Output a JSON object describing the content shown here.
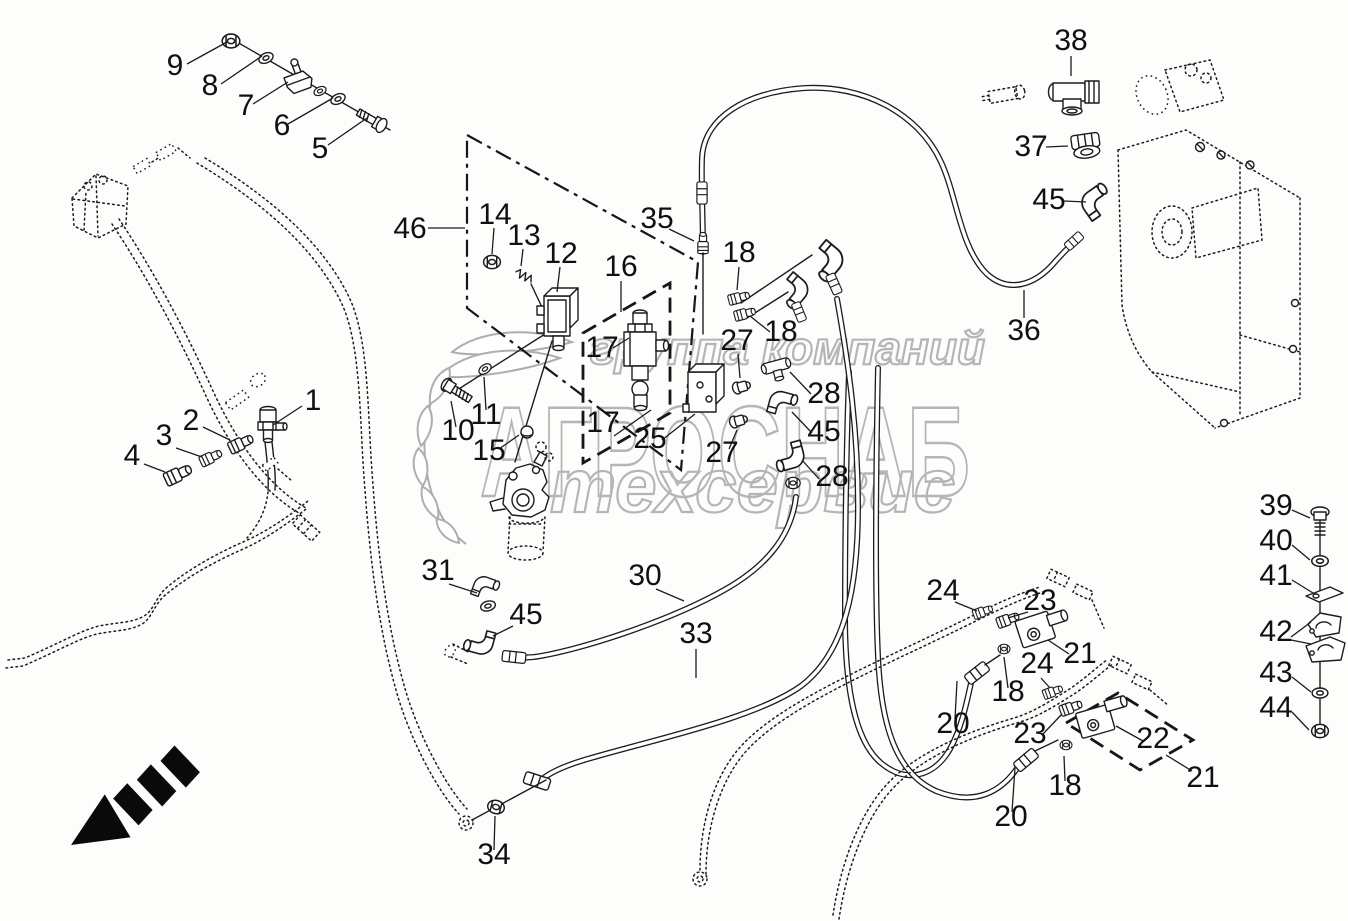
{
  "figure": {
    "type": "exploded-parts-diagram",
    "background": "#fdfdfb",
    "line_color": "#1c1c1c",
    "watermark": {
      "line1": "группа компаний",
      "line2": "АГРОСНАБ",
      "line3": "техсервис",
      "color": "#b5b5b5",
      "emblem": "laurel-wreath"
    },
    "direction_arrow": {
      "meaning": "viewing-direction-arrow",
      "points": "down-left"
    },
    "callouts": [
      {
        "label": "9",
        "x": 175,
        "y": 75,
        "leader": [
          187,
          64,
          227,
          42
        ]
      },
      {
        "label": "8",
        "x": 210,
        "y": 95,
        "leader": [
          221,
          84,
          262,
          56
        ]
      },
      {
        "label": "7",
        "x": 246,
        "y": 115,
        "leader": [
          253,
          104,
          288,
          82
        ]
      },
      {
        "label": "6",
        "x": 282,
        "y": 135,
        "leader": [
          288,
          124,
          333,
          98
        ]
      },
      {
        "label": "5",
        "x": 320,
        "y": 158,
        "leader": [
          328,
          145,
          367,
          118
        ]
      },
      {
        "label": "46",
        "x": 410,
        "y": 238,
        "leader": [
          428,
          228,
          465,
          228
        ]
      },
      {
        "label": "14",
        "x": 495,
        "y": 224,
        "leader": [
          494,
          228,
          492,
          254
        ]
      },
      {
        "label": "13",
        "x": 524,
        "y": 245,
        "leader": [
          523,
          249,
          521,
          266
        ]
      },
      {
        "label": "12",
        "x": 561,
        "y": 263,
        "leader": [
          560,
          267,
          557,
          292
        ]
      },
      {
        "label": "16",
        "x": 621,
        "y": 276,
        "leader": [
          621,
          281,
          621,
          312
        ]
      },
      {
        "label": "35",
        "x": 657,
        "y": 228,
        "leader": [
          669,
          229,
          694,
          241
        ]
      },
      {
        "label": "18",
        "x": 739,
        "y": 262,
        "leader": [
          739,
          267,
          737,
          290
        ]
      },
      {
        "label": "18",
        "x": 781,
        "y": 341,
        "leader": [
          770,
          332,
          750,
          316
        ]
      },
      {
        "label": "27",
        "x": 737,
        "y": 350,
        "leader": [
          738,
          354,
          740,
          378
        ]
      },
      {
        "label": "28",
        "x": 824,
        "y": 403,
        "leader": [
          811,
          394,
          790,
          372
        ]
      },
      {
        "label": "45",
        "x": 824,
        "y": 441,
        "leader": [
          812,
          433,
          792,
          412
        ]
      },
      {
        "label": "27",
        "x": 722,
        "y": 462,
        "leader": [
          729,
          449,
          737,
          430
        ]
      },
      {
        "label": "28",
        "x": 832,
        "y": 486,
        "leader": [
          819,
          479,
          802,
          460
        ]
      },
      {
        "label": "17",
        "x": 602,
        "y": 357,
        "leader": [
          613,
          348,
          629,
          338
        ]
      },
      {
        "label": "17",
        "x": 603,
        "y": 432,
        "leader": [
          614,
          436,
          651,
          410
        ]
      },
      {
        "label": "25",
        "x": 650,
        "y": 448,
        "leader": [
          662,
          440,
          695,
          414
        ]
      },
      {
        "label": "10",
        "x": 458,
        "y": 440,
        "leader": [
          456,
          427,
          451,
          401
        ]
      },
      {
        "label": "11",
        "x": 486,
        "y": 424,
        "leader": [
          486,
          410,
          484,
          377
        ]
      },
      {
        "label": "15",
        "x": 489,
        "y": 460,
        "leader": [
          499,
          449,
          519,
          435
        ]
      },
      {
        "label": "31",
        "x": 438,
        "y": 580,
        "leader": [
          449,
          584,
          477,
          593
        ]
      },
      {
        "label": "45",
        "x": 526,
        "y": 624,
        "leader": [
          513,
          626,
          493,
          636
        ]
      },
      {
        "label": "30",
        "x": 645,
        "y": 585,
        "leader": [
          656,
          589,
          684,
          601
        ]
      },
      {
        "label": "33",
        "x": 696,
        "y": 643,
        "leader": [
          696,
          649,
          696,
          678
        ]
      },
      {
        "label": "34",
        "x": 494,
        "y": 864,
        "leader": [
          494,
          850,
          495,
          816
        ]
      },
      {
        "label": "36",
        "x": 1024,
        "y": 340,
        "leader": [
          1024,
          318,
          1024,
          290
        ]
      },
      {
        "label": "38",
        "x": 1071,
        "y": 50,
        "leader": [
          1071,
          56,
          1071,
          76
        ]
      },
      {
        "label": "37",
        "x": 1031,
        "y": 156,
        "leader": [
          1046,
          147,
          1068,
          146
        ]
      },
      {
        "label": "45",
        "x": 1049,
        "y": 209,
        "leader": [
          1064,
          201,
          1086,
          202
        ]
      },
      {
        "label": "24",
        "x": 943,
        "y": 600,
        "leader": [
          955,
          602,
          977,
          611
        ]
      },
      {
        "label": "23",
        "x": 1040,
        "y": 610,
        "leader": [
          1028,
          612,
          1008,
          618
        ]
      },
      {
        "label": "21",
        "x": 1080,
        "y": 663,
        "leader": [
          1069,
          654,
          1048,
          640
        ]
      },
      {
        "label": "18",
        "x": 1008,
        "y": 701,
        "leader": [
          1008,
          688,
          1004,
          657
        ]
      },
      {
        "label": "20",
        "x": 953,
        "y": 733,
        "leader": [
          955,
          719,
          957,
          681
        ]
      },
      {
        "label": "24",
        "x": 1037,
        "y": 673,
        "leader": [
          1041,
          678,
          1050,
          688
        ]
      },
      {
        "label": "23",
        "x": 1030,
        "y": 743,
        "leader": [
          1042,
          735,
          1062,
          714
        ]
      },
      {
        "label": "22",
        "x": 1153,
        "y": 748,
        "leader": [
          1143,
          741,
          1116,
          726
        ]
      },
      {
        "label": "21",
        "x": 1203,
        "y": 787,
        "leader": [
          1192,
          771,
          1166,
          755
        ]
      },
      {
        "label": "18",
        "x": 1065,
        "y": 795,
        "leader": [
          1065,
          781,
          1064,
          756
        ]
      },
      {
        "label": "20",
        "x": 1011,
        "y": 826,
        "leader": [
          1012,
          812,
          1015,
          768
        ]
      },
      {
        "label": "39",
        "x": 1276,
        "y": 515,
        "leader": [
          1292,
          510,
          1310,
          518
        ]
      },
      {
        "label": "40",
        "x": 1276,
        "y": 550,
        "leader": [
          1292,
          545,
          1310,
          560
        ]
      },
      {
        "label": "41",
        "x": 1276,
        "y": 585,
        "leader": [
          1292,
          580,
          1313,
          593
        ]
      },
      {
        "label": "42",
        "x": 1276,
        "y": 641,
        "leader": [
          1291,
          637,
          1311,
          622
        ],
        "leader2": [
          1291,
          640,
          1311,
          644
        ]
      },
      {
        "label": "43",
        "x": 1276,
        "y": 682,
        "leader": [
          1292,
          677,
          1311,
          692
        ]
      },
      {
        "label": "44",
        "x": 1276,
        "y": 717,
        "leader": [
          1292,
          712,
          1309,
          730
        ]
      },
      {
        "label": "1",
        "x": 313,
        "y": 410,
        "leader": [
          302,
          406,
          273,
          425
        ]
      },
      {
        "label": "2",
        "x": 191,
        "y": 430,
        "leader": [
          203,
          427,
          230,
          440
        ]
      },
      {
        "label": "3",
        "x": 164,
        "y": 445,
        "leader": [
          176,
          448,
          202,
          457
        ]
      },
      {
        "label": "4",
        "x": 132,
        "y": 465,
        "leader": [
          144,
          464,
          165,
          472
        ]
      }
    ]
  }
}
